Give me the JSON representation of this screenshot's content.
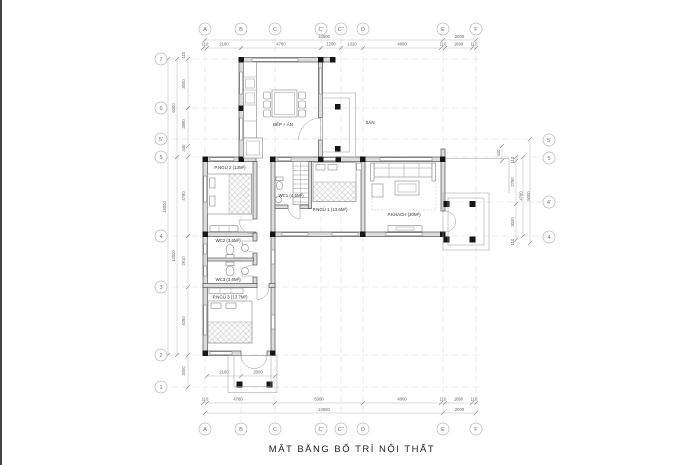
{
  "title": "MẶT BẰNG BỐ TRÍ NỘI THẤT",
  "axis_labels": {
    "top": [
      "A",
      "B",
      "C",
      "C'",
      "C''",
      "D",
      "E",
      "F"
    ],
    "bottom": [
      "A",
      "B",
      "C",
      "C'",
      "C''",
      "D",
      "E",
      "F"
    ],
    "left": [
      "7",
      "6",
      "5'",
      "5",
      "4",
      "3",
      "2",
      "1"
    ],
    "right": [
      "5'",
      "5",
      "4'",
      "4"
    ]
  },
  "rooms": {
    "kitchen_dining": "BẾP + ĂN",
    "yard": "SÂN",
    "bedroom2": "P.NGỦ 2 (13M²)",
    "wc1": "WC1 (4.5M²)",
    "bedroom1": "P.NGỦ 1 (13.6M²)",
    "living_room": "P.KHÁCH (20M²)",
    "wc2": "WC2 (3.6M²)",
    "wc3": "WC3 (3.6M²)",
    "bedroom3": "P.NGỦ 3 (13.7M²)"
  },
  "dimensions": {
    "top": {
      "overall": "14500",
      "right_overall": "2000",
      "segments": [
        "110",
        "2180",
        "4780",
        "1200",
        "1320",
        "4800",
        "110",
        "1890",
        "110"
      ]
    },
    "bottom": {
      "overall": "14500",
      "right_overall": "2000",
      "segments": [
        "110",
        "4780",
        "5300",
        "4800",
        "110",
        "1890",
        "110"
      ],
      "porch": [
        "2180",
        "2000"
      ]
    },
    "left": {
      "overall": "18000",
      "mid": [
        "6000",
        "12000"
      ],
      "segments": [
        "110",
        "3000",
        "2890",
        "440",
        "4780",
        "2910",
        "4050",
        "2000"
      ]
    },
    "right": {
      "overall": [
        "4780",
        "5000"
      ],
      "segments": [
        "440",
        "110",
        "2780",
        "3000",
        "110"
      ]
    }
  },
  "colors": {
    "wall_line": "#555555",
    "wall_fill": "#dcdcdc",
    "grid": "#dddddd",
    "column": "#161616",
    "dim_text": "#666666"
  }
}
